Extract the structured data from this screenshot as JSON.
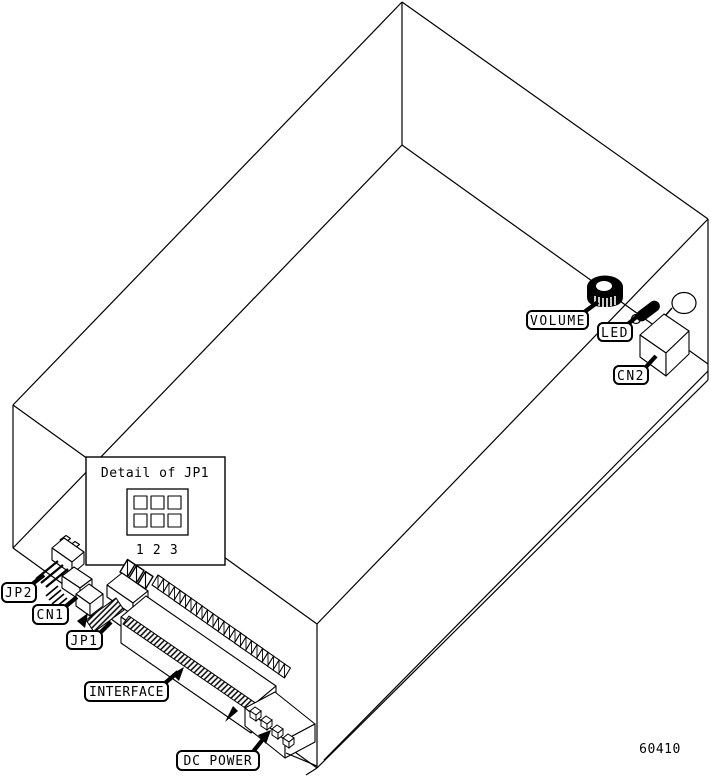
{
  "figure": {
    "type": "hardware-rear-panel-diagram",
    "part_number": "60410",
    "colors": {
      "ink": "#000000",
      "paper": "#ffffff"
    },
    "detail_inset": {
      "title": "Detail of JP1",
      "pin_numbers": [
        "1",
        "2",
        "3"
      ]
    },
    "labels": {
      "volume": "VOLUME",
      "led": "LED",
      "cn2": "CN2",
      "jp2": "JP2",
      "cn1": "CN1",
      "jp1": "JP1",
      "interface": "INTERFACE",
      "dc_power": "DC POWER"
    }
  }
}
